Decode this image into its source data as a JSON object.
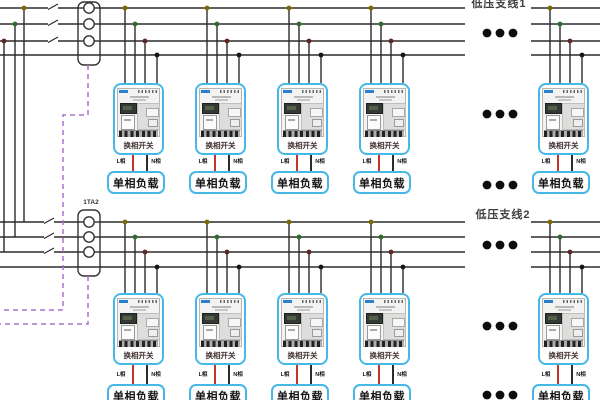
{
  "labels": {
    "branch_line_1": "低压支线1",
    "branch_line_2": "低压支线2",
    "current_transformer_2": "1TA2",
    "phase_switch": "换相开关",
    "single_phase_load": "单相负载",
    "live_phase": "L相",
    "neutral_phase": "N相"
  },
  "colors": {
    "bus_wire": "#2b2b2b",
    "phase_a_tap": "#7c6a00",
    "phase_b_tap": "#2f6b31",
    "phase_c_tap": "#5e2727",
    "neutral_tap": "#151515",
    "live_wire": "#c63327",
    "neutral_wire": "#2b2b2b",
    "device_box_border": "#45b8e6",
    "ct_signal_dashed": "#a873cc"
  }
}
